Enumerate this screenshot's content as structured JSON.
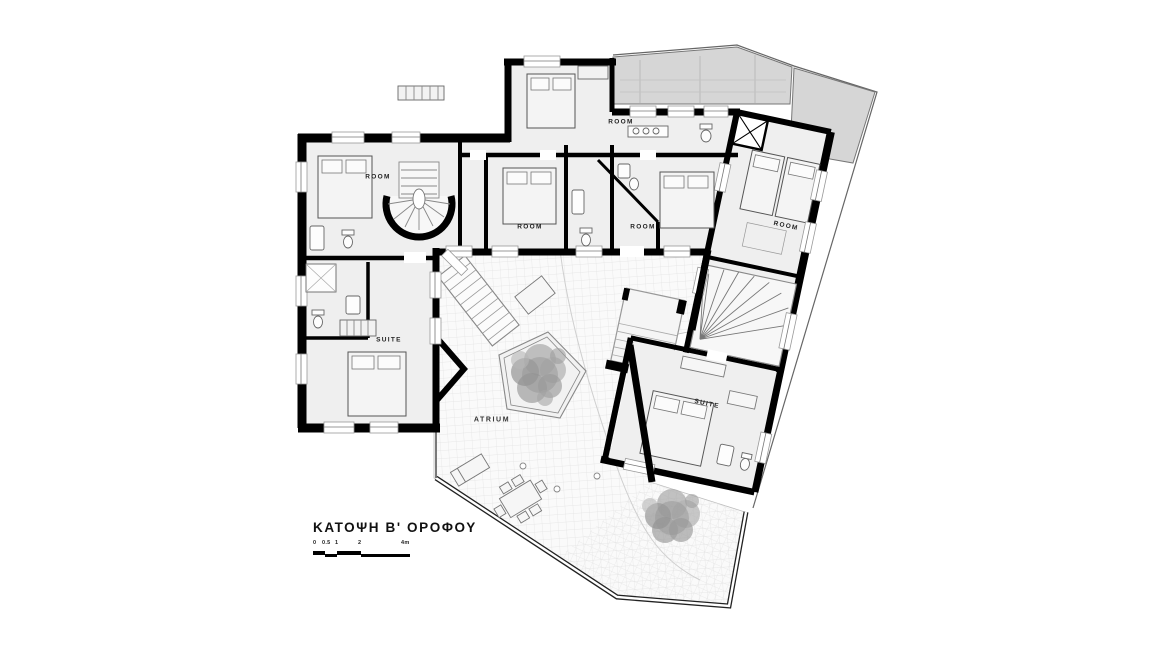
{
  "title": {
    "text": "ΚΑΤΟΨΗ Β' ΟΡΟΦΟΥ"
  },
  "scale_bar": {
    "labels": [
      "0",
      "0.5",
      "1",
      "2",
      "4m"
    ]
  },
  "plan": {
    "labels": [
      {
        "text": "ROOM",
        "room": "top-room"
      },
      {
        "text": "ROOM",
        "room": "left-room"
      },
      {
        "text": "ROOM",
        "room": "center-left-room"
      },
      {
        "text": "ROOM",
        "room": "center-right-room"
      },
      {
        "text": "ROOM",
        "room": "right-wing-room"
      },
      {
        "text": "SUITE",
        "room": "left-suite"
      },
      {
        "text": "SUITE",
        "room": "right-suite"
      },
      {
        "text": "ATRIUM",
        "room": "atrium-courtyard"
      }
    ]
  },
  "colors": {
    "walls": "#000000",
    "room_floor": "#efefef",
    "atrium_floor": "#fafafa",
    "terrace": "#d6d6d6",
    "foliage": "#9a9a9a",
    "background": "#ffffff"
  }
}
